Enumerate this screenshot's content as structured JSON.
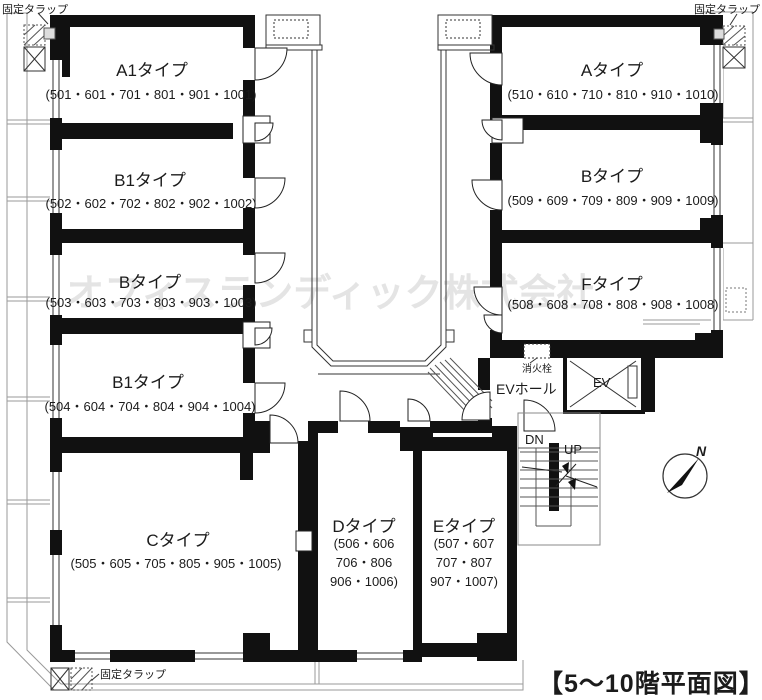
{
  "meta": {
    "caption": "【5〜10階平面図】",
    "watermark": "オフィスランディック株式会社"
  },
  "rooms": [
    {
      "id": "a1",
      "name": "A1タイプ",
      "units": "(501・601・701・801・901・1001)"
    },
    {
      "id": "b1a",
      "name": "B1タイプ",
      "units": "(502・602・702・802・902・1002)"
    },
    {
      "id": "b",
      "name": "Bタイプ",
      "units": "(503・603・703・803・903・1003)"
    },
    {
      "id": "b1b",
      "name": "B1タイプ",
      "units": "(504・604・704・804・904・1004)"
    },
    {
      "id": "c",
      "name": "Cタイプ",
      "units": "(505・605・705・805・905・1005)"
    },
    {
      "id": "d",
      "name": "Dタイプ",
      "units": "(506・606\n706・806\n906・1006)"
    },
    {
      "id": "e",
      "name": "Eタイプ",
      "units": "(507・607\n707・807\n907・1007)"
    },
    {
      "id": "f",
      "name": "Fタイプ",
      "units": "(508・608・708・808・908・1008)"
    },
    {
      "id": "b2",
      "name": "Bタイプ",
      "units": "(509・609・709・809・909・1009)"
    },
    {
      "id": "a",
      "name": "Aタイプ",
      "units": "(510・610・710・810・910・1010)"
    }
  ],
  "labels": {
    "fixed_ladder": "固定タラップ",
    "fire_hydrant": "消火栓",
    "ev_hall": "EVホール",
    "ev": "EV",
    "down": "DN",
    "up": "UP",
    "north": "N"
  },
  "colors": {
    "wall": "#111111",
    "line": "#333333",
    "balcony": "#9a9a9a",
    "watermark": "#e4e4e4",
    "text": "#1b1b1b"
  }
}
